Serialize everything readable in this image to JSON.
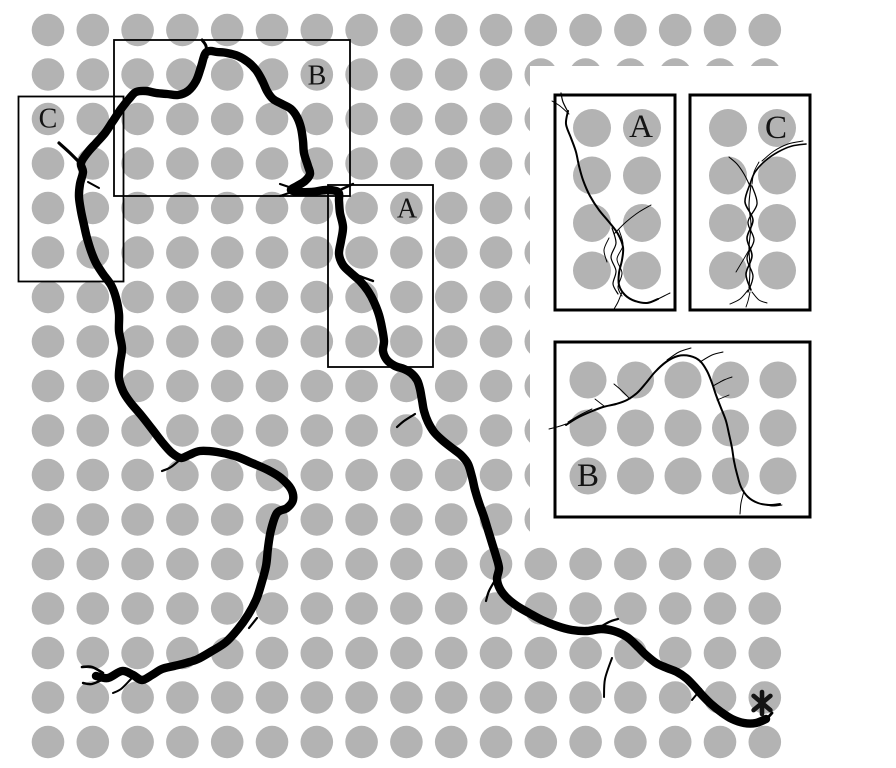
{
  "figure": {
    "background": "#ffffff",
    "pillar_color": "#b3b3b3",
    "chain_color": "#000000",
    "label_color": "#141414",
    "main_grid": {
      "cols": 17,
      "rows": 17,
      "x0": 48,
      "y0": 30,
      "dx": 44.8,
      "dy": 44.5,
      "radius": 16.3
    },
    "inset_mask": {
      "x": 530,
      "y": 66,
      "w": 366,
      "h": 474
    },
    "region_boxes": [
      {
        "id": "C",
        "label": "C",
        "x": 18.5,
        "y": 96.5,
        "w": 105,
        "h": 185,
        "label_x": 48,
        "label_y": 119
      },
      {
        "id": "B",
        "label": "B",
        "x": 114,
        "y": 40,
        "w": 236,
        "h": 156,
        "label_x": 317,
        "label_y": 76
      },
      {
        "id": "A",
        "label": "A",
        "x": 328,
        "y": 185,
        "w": 105,
        "h": 182,
        "label_x": 407,
        "label_y": 209
      }
    ],
    "chain": {
      "width": 8.4,
      "points": [
        96,
        676,
        108,
        678,
        122,
        671,
        133,
        675,
        142,
        680,
        152,
        675,
        162,
        669,
        174,
        666,
        186,
        663,
        198,
        659,
        212,
        651,
        226,
        642,
        238,
        629,
        248,
        615,
        256,
        600,
        261,
        585,
        266,
        566,
        268,
        548,
        271,
        530,
        277,
        513,
        287,
        508,
        293,
        500,
        291,
        489,
        281,
        478,
        268,
        470,
        252,
        463,
        235,
        456,
        217,
        452,
        200,
        451,
        189,
        455,
        181,
        458,
        172,
        453,
        162,
        442,
        152,
        429,
        141,
        415,
        130,
        402,
        123,
        391,
        119,
        378,
        120,
        363,
        122,
        348,
        119,
        331,
        119,
        314,
        116,
        298,
        111,
        285,
        103,
        274,
        96,
        263,
        91,
        251,
        87,
        238,
        84,
        225,
        81,
        211,
        79,
        197,
        80,
        184,
        83,
        172,
        81,
        163,
        88,
        152,
        97,
        142,
        105,
        133,
        113,
        121,
        121,
        109,
        129,
        99,
        136,
        92,
        146,
        91,
        156,
        93,
        167,
        94,
        178,
        95,
        188,
        91,
        196,
        81,
        201,
        67,
        205,
        54,
        210,
        51,
        217,
        52,
        227,
        53,
        238,
        56,
        248,
        62,
        256,
        70,
        262,
        80,
        267,
        91,
        273,
        99,
        282,
        104,
        291,
        109,
        297,
        117,
        301,
        128,
        303,
        141,
        304,
        153,
        308,
        166,
        310,
        174,
        305,
        181,
        297,
        186,
        291,
        190,
        299,
        192,
        312,
        192,
        326,
        190,
        338,
        192,
        339,
        201,
        340,
        213,
        343,
        227,
        341,
        241,
        339,
        254,
        343,
        265,
        351,
        273,
        360,
        281,
        368,
        291,
        374,
        302,
        379,
        315,
        382,
        328,
        384,
        341,
        383,
        351,
        387,
        360,
        395,
        366,
        404,
        369,
        411,
        373,
        417,
        380,
        420,
        389,
        422,
        400,
        424,
        411,
        428,
        422,
        434,
        432,
        442,
        440,
        452,
        448,
        461,
        455,
        468,
        464,
        472,
        477,
        475,
        490,
        479,
        503,
        484,
        517,
        488,
        530,
        492,
        543,
        496,
        556,
        499,
        568,
        497,
        579,
        500,
        589,
        507,
        598,
        517,
        606,
        529,
        613,
        542,
        620,
        557,
        626,
        572,
        630,
        587,
        631,
        601,
        629,
        614,
        631,
        627,
        637,
        637,
        646,
        646,
        655,
        656,
        663,
        667,
        668,
        677,
        672,
        686,
        678,
        694,
        686,
        702,
        695,
        711,
        704,
        721,
        712,
        732,
        719,
        744,
        723,
        756,
        723,
        766,
        719
      ]
    },
    "chain_barbs": [
      {
        "w": 2.6,
        "points": [
          103,
          673,
          92,
          667,
          82,
          667
        ]
      },
      {
        "w": 2.4,
        "points": [
          104,
          679,
          92,
          684,
          83,
          683
        ]
      },
      {
        "w": 2.0,
        "points": [
          131,
          679,
          121,
          689,
          113,
          693
        ]
      },
      {
        "w": 2.2,
        "points": [
          249,
          628,
          257,
          618
        ]
      },
      {
        "w": 2.2,
        "points": [
          183,
          457,
          171,
          467,
          162,
          471
        ]
      },
      {
        "w": 2.0,
        "points": [
          88,
          182,
          99,
          188
        ]
      },
      {
        "w": 3.2,
        "points": [
          82,
          165,
          70,
          153,
          59,
          143
        ]
      },
      {
        "w": 3.0,
        "points": [
          207,
          57,
          206,
          46,
          202,
          40
        ]
      },
      {
        "w": 2.2,
        "points": [
          292,
          188,
          280,
          184
        ]
      },
      {
        "w": 2.0,
        "points": [
          292,
          192,
          280,
          196
        ]
      },
      {
        "w": 2.4,
        "points": [
          340,
          190,
          353,
          184
        ]
      },
      {
        "w": 2.4,
        "points": [
          349,
          272,
          362,
          277,
          373,
          281
        ]
      },
      {
        "w": 2.2,
        "points": [
          415,
          414,
          404,
          421,
          397,
          427
        ]
      },
      {
        "w": 2.2,
        "points": [
          497,
          577,
          489,
          591,
          486,
          601
        ]
      },
      {
        "w": 2.2,
        "points": [
          597,
          629,
          609,
          622,
          618,
          619
        ]
      },
      {
        "w": 2.0,
        "points": [
          612,
          658,
          605,
          679,
          604,
          697
        ]
      },
      {
        "w": 2.0,
        "points": [
          701,
          689,
          692,
          700
        ]
      },
      {
        "w": 2.8,
        "points": [
          756,
          723,
          767,
          718,
          772,
          713
        ]
      }
    ],
    "insets": [
      {
        "id": "A",
        "label": "A",
        "x": 555,
        "y": 95,
        "w": 120,
        "h": 215,
        "label_x": 641,
        "label_y": 127,
        "pillars": {
          "cols": [
            592,
            642
          ],
          "rows": [
            128,
            175.5,
            223,
            270.5
          ],
          "radius": 19
        },
        "strands": [
          {
            "w": 2.0,
            "points": [
              568,
              111,
              566,
              124,
              571,
              138,
              576,
              152,
              579,
              166,
              583,
              180,
              590,
              196,
              599,
              210,
              609,
              222,
              618,
              234,
              623,
              247,
              622,
              260,
              619,
              273,
              619,
              285,
              625,
              295,
              635,
              301,
              647,
              303,
              658,
              299
            ]
          },
          {
            "w": 1.2,
            "points": [
              612,
              228,
              616,
              243,
              611,
              257,
              616,
              271,
              613,
              284,
              618,
              294
            ]
          },
          {
            "w": 1.0,
            "points": [
              619,
              230,
              623,
              245,
              617,
              259,
              622,
              273,
              618,
              287,
              622,
              296
            ]
          },
          {
            "w": 1.0,
            "points": [
              614,
              234,
              626,
              222,
              639,
              212,
              651,
              205
            ]
          },
          {
            "w": 1.2,
            "points": [
              568,
              112,
              563,
              102,
              561,
              93
            ]
          },
          {
            "w": 1.0,
            "points": [
              569,
              114,
              560,
              106,
              552,
              101
            ]
          },
          {
            "w": 1.0,
            "points": [
              656,
              300,
              664,
              296,
              670,
              293
            ]
          },
          {
            "w": 1.0,
            "points": [
              622,
              292,
              618,
              302,
              614,
              309
            ]
          },
          {
            "w": 1.0,
            "points": [
              609,
              238,
              604,
              250,
              607,
              262
            ]
          }
        ]
      },
      {
        "id": "C",
        "label": "C",
        "x": 690,
        "y": 95,
        "w": 120,
        "h": 215,
        "label_x": 776,
        "label_y": 128,
        "pillars": {
          "cols": [
            728,
            777
          ],
          "rows": [
            128,
            175.5,
            223,
            270.5
          ],
          "radius": 19
        },
        "strands": [
          {
            "w": 1.6,
            "points": [
              806,
              144,
              792,
              146,
              778,
              152,
              765,
              161,
              755,
              172,
              750,
              184
            ]
          },
          {
            "w": 1.0,
            "points": [
              803,
              141,
              788,
              144,
              774,
              151,
              762,
              161
            ]
          },
          {
            "w": 1.6,
            "points": [
              750,
              184,
              745,
              202,
              753,
              220,
              747,
              238,
              752,
              256,
              746,
              274,
              751,
              290
            ]
          },
          {
            "w": 1.3,
            "points": [
              752,
              186,
              757,
              204,
              748,
              222,
              754,
              240,
              747,
              258,
              753,
              276,
              748,
              292
            ]
          },
          {
            "w": 1.1,
            "points": [
              751,
              185,
              749,
              205,
              751,
              225,
              749,
              247,
              750,
              268,
              749,
              288
            ]
          },
          {
            "w": 1.1,
            "points": [
              750,
              186,
              744,
              174,
              737,
              164,
              729,
              157
            ]
          },
          {
            "w": 0.9,
            "points": [
              752,
              184,
              754,
              172,
              759,
              162
            ]
          },
          {
            "w": 1.0,
            "points": [
              748,
              290,
              740,
              299,
              730,
              304
            ]
          },
          {
            "w": 1.0,
            "points": [
              752,
              292,
              759,
              300,
              767,
              303
            ]
          },
          {
            "w": 0.9,
            "points": [
              750,
              292,
              748,
              301,
              746,
              307
            ]
          },
          {
            "w": 0.9,
            "points": [
              749,
              250,
              742,
              262,
              736,
              272
            ]
          }
        ]
      },
      {
        "id": "B",
        "label": "B",
        "x": 555,
        "y": 342,
        "w": 255,
        "h": 175,
        "label_x": 588,
        "label_y": 476,
        "pillars": {
          "cols": [
            588,
            635.5,
            683,
            730.5,
            778
          ],
          "rows": [
            380,
            428,
            476
          ],
          "radius": 18.5
        },
        "strands": [
          {
            "w": 2.0,
            "points": [
              566,
              425,
              577,
              418,
              590,
              412,
              603,
              407,
              616,
              404,
              627,
              400,
              637,
              393,
              646,
              383,
              655,
              372,
              666,
              362,
              678,
              356,
              690,
              356,
              700,
              361,
              707,
              371,
              712,
              383,
              716,
              395,
              721,
              408,
              726,
              421,
              729,
              434,
              732,
              448,
              734,
              461,
              737,
              474,
              741,
              487,
              748,
              497,
              758,
              503,
              769,
              505,
              780,
              504
            ]
          },
          {
            "w": 1.0,
            "points": [
              566,
              424,
              557,
              427,
              549,
              429
            ]
          },
          {
            "w": 1.0,
            "points": [
              568,
              422,
              580,
              415,
              592,
              409
            ]
          },
          {
            "w": 1.0,
            "points": [
              630,
              399,
              621,
              390,
              614,
              384
            ]
          },
          {
            "w": 1.0,
            "points": [
              667,
              360,
              679,
              352,
              691,
              348
            ]
          },
          {
            "w": 1.0,
            "points": [
              700,
              362,
              712,
              355,
              723,
              352
            ]
          },
          {
            "w": 1.0,
            "points": [
              713,
              386,
              724,
              380,
              732,
              377
            ]
          },
          {
            "w": 0.9,
            "points": [
              717,
              400,
              729,
              395
            ]
          },
          {
            "w": 1.0,
            "points": [
              744,
              491,
              741,
              503,
              740,
              514
            ]
          },
          {
            "w": 0.9,
            "points": [
              762,
              504,
              772,
              506,
              782,
              505
            ]
          },
          {
            "w": 0.9,
            "points": [
              604,
              406,
              595,
              399
            ]
          }
        ]
      }
    ],
    "asterisk": {
      "symbol": "*",
      "x": 762,
      "y": 703,
      "radius": 11,
      "stroke_width": 4.6
    },
    "label_font_size": 28,
    "inset_label_font_size": 33
  }
}
